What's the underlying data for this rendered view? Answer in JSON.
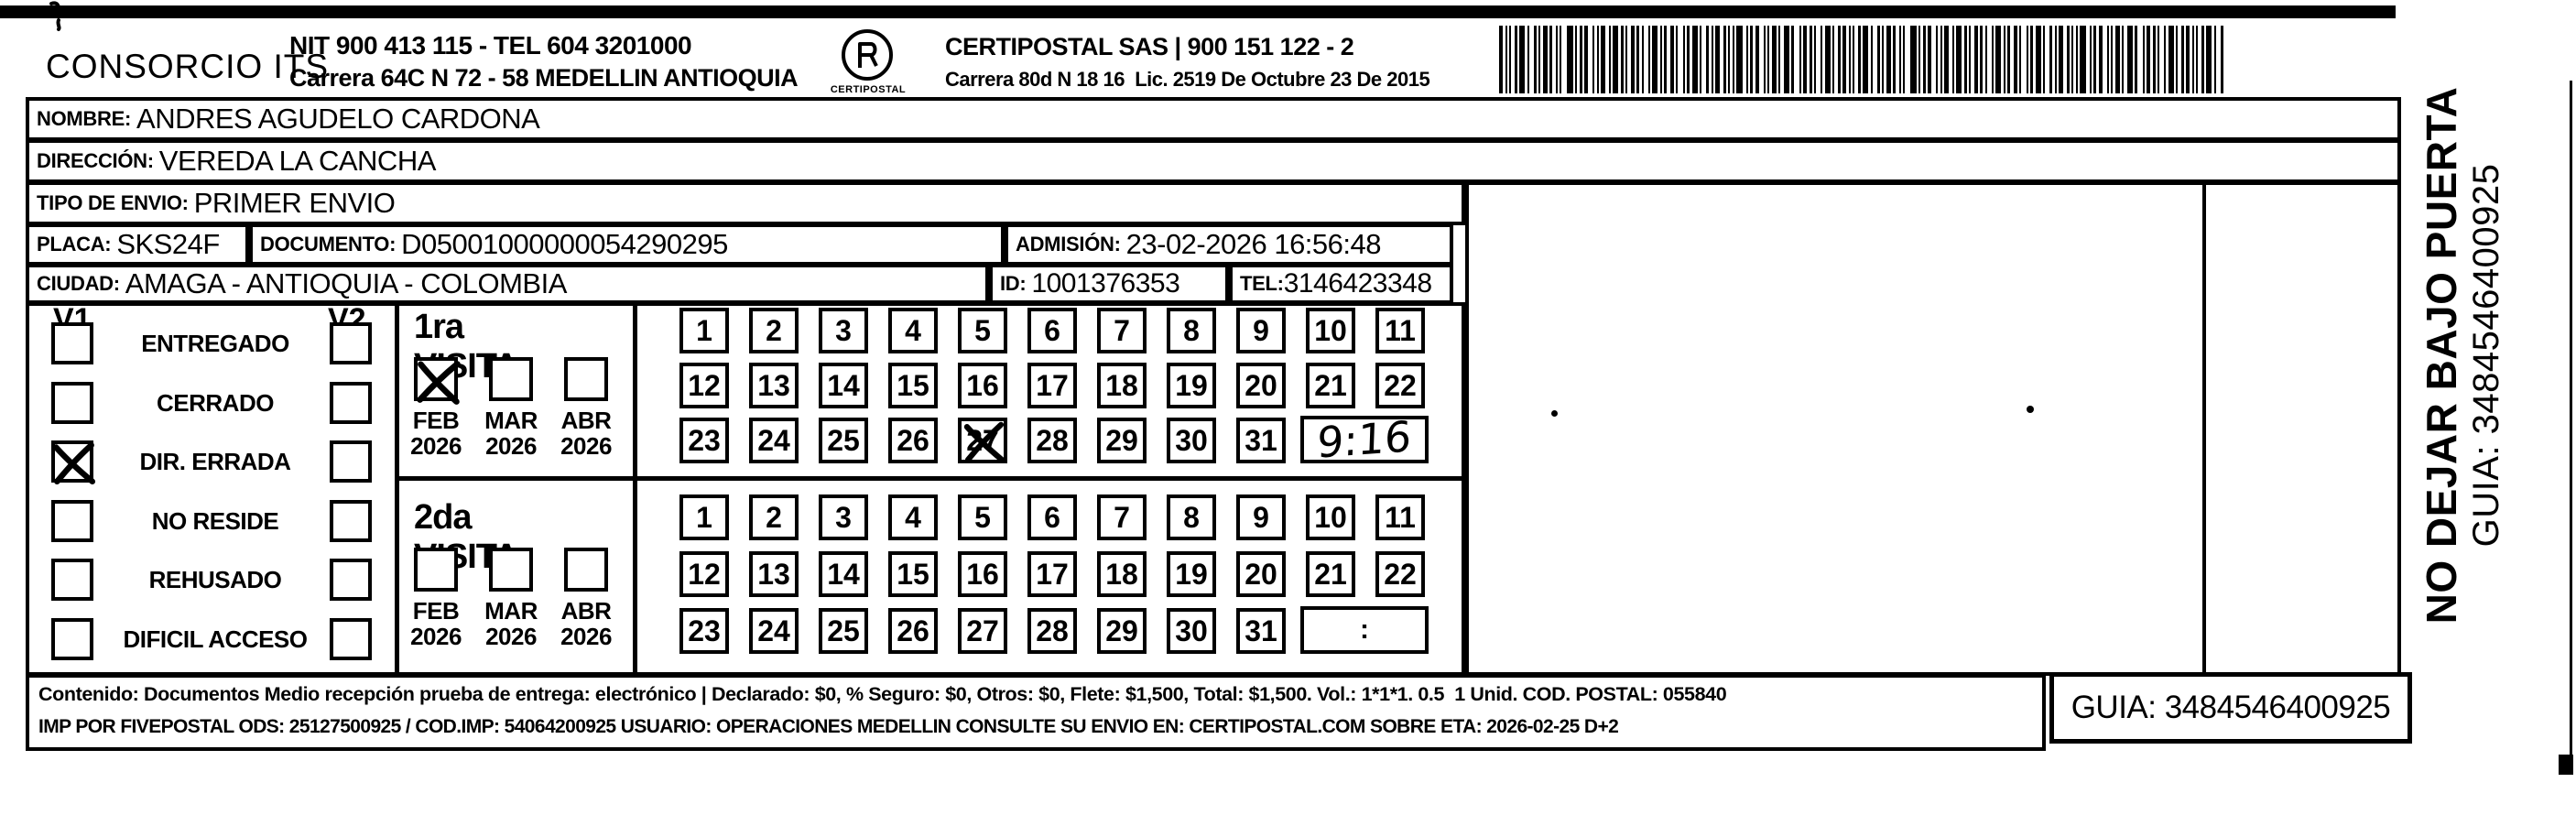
{
  "header": {
    "company": "CONSORCIO ITS",
    "company_info_line1": "NIT 900 413 115 - TEL 604 3201000",
    "company_info_line2": "Carrera 64C N 72 - 58 MEDELLIN ANTIOQUIA",
    "logo_caption": "CERTIPOSTAL",
    "carrier_line1": "CERTIPOSTAL SAS | 900 151 122 - 2",
    "carrier_line2": "Carrera 80d N 18 16  Lic. 2519 De Octubre 23 De 2015"
  },
  "fields": {
    "nombre": {
      "label": "NOMBRE:",
      "value": "ANDRES AGUDELO CARDONA"
    },
    "direccion": {
      "label": "DIRECCIÓN:",
      "value": "VEREDA LA CANCHA"
    },
    "tipo_envio": {
      "label": "TIPO DE ENVIO:",
      "value": "PRIMER ENVIO"
    },
    "placa": {
      "label": "PLACA:",
      "value": "SKS24F"
    },
    "documento": {
      "label": "DOCUMENTO:",
      "value": "D05001000000054290295"
    },
    "admision": {
      "label": "ADMISIÓN:",
      "value": "23-02-2026 16:56:48"
    },
    "ciudad": {
      "label": "CIUDAD:",
      "value": "AMAGA - ANTIOQUIA - COLOMBIA"
    },
    "id": {
      "label": "ID:",
      "value": "1001376353"
    },
    "tel": {
      "label": "TEL:",
      "value": "3146423348"
    }
  },
  "columns": {
    "firma": "FIRMA QUIEN RECIBE",
    "observaciones": "OBSERVACIONES"
  },
  "status": {
    "v1": "V1",
    "v2": "V2",
    "items": [
      {
        "label": "ENTREGADO",
        "v1_checked": false,
        "v2_checked": false
      },
      {
        "label": "CERRADO",
        "v1_checked": false,
        "v2_checked": false
      },
      {
        "label": "DIR. ERRADA",
        "v1_checked": true,
        "v2_checked": false
      },
      {
        "label": "NO RESIDE",
        "v1_checked": false,
        "v2_checked": false
      },
      {
        "label": "REHUSADO",
        "v1_checked": false,
        "v2_checked": false
      },
      {
        "label": "DIFICIL ACCESO",
        "v1_checked": false,
        "v2_checked": false
      }
    ]
  },
  "calendar_rows": [
    [
      "1",
      "2",
      "3",
      "4",
      "5",
      "6",
      "7",
      "8",
      "9",
      "10",
      "11"
    ],
    [
      "12",
      "13",
      "14",
      "15",
      "16",
      "17",
      "18",
      "19",
      "20",
      "21",
      "22"
    ],
    [
      "23",
      "24",
      "25",
      "26",
      "27",
      "28",
      "29",
      "30",
      "31"
    ]
  ],
  "visits": [
    {
      "title": "1ra VISITA",
      "months": [
        {
          "month": "FEB",
          "year": "2026",
          "checked": true
        },
        {
          "month": "MAR",
          "year": "2026",
          "checked": false
        },
        {
          "month": "ABR",
          "year": "2026",
          "checked": false
        }
      ],
      "crossed_days": [
        "27"
      ],
      "time_value": "9:16",
      "time_handwritten": true
    },
    {
      "title": "2da VISITA",
      "months": [
        {
          "month": "FEB",
          "year": "2026",
          "checked": false
        },
        {
          "month": "MAR",
          "year": "2026",
          "checked": false
        },
        {
          "month": "ABR",
          "year": "2026",
          "checked": false
        }
      ],
      "crossed_days": [],
      "time_value": ":",
      "time_handwritten": false
    }
  ],
  "footer": {
    "line1": "Contenido: Documentos Medio recepción prueba de entrega: electrónico | Declarado: $0, % Seguro: $0, Otros: $0, Flete: $1,500, Total: $1,500. Vol.: 1*1*1. 0.5  1 Unid. COD. POSTAL: 055840",
    "line2": "IMP POR FIVEPOSTAL ODS: 25127500925 / COD.IMP: 54064200925 USUARIO: OPERACIONES MEDELLIN CONSULTE SU ENVIO EN: CERTIPOSTAL.COM SOBRE ETA: 2026-02-25 D+2",
    "guia": "GUIA: 3484546400925"
  },
  "side": {
    "warning": "NO DEJAR BAJO PUERTA",
    "guia": "GUIA: 3484546400925"
  }
}
